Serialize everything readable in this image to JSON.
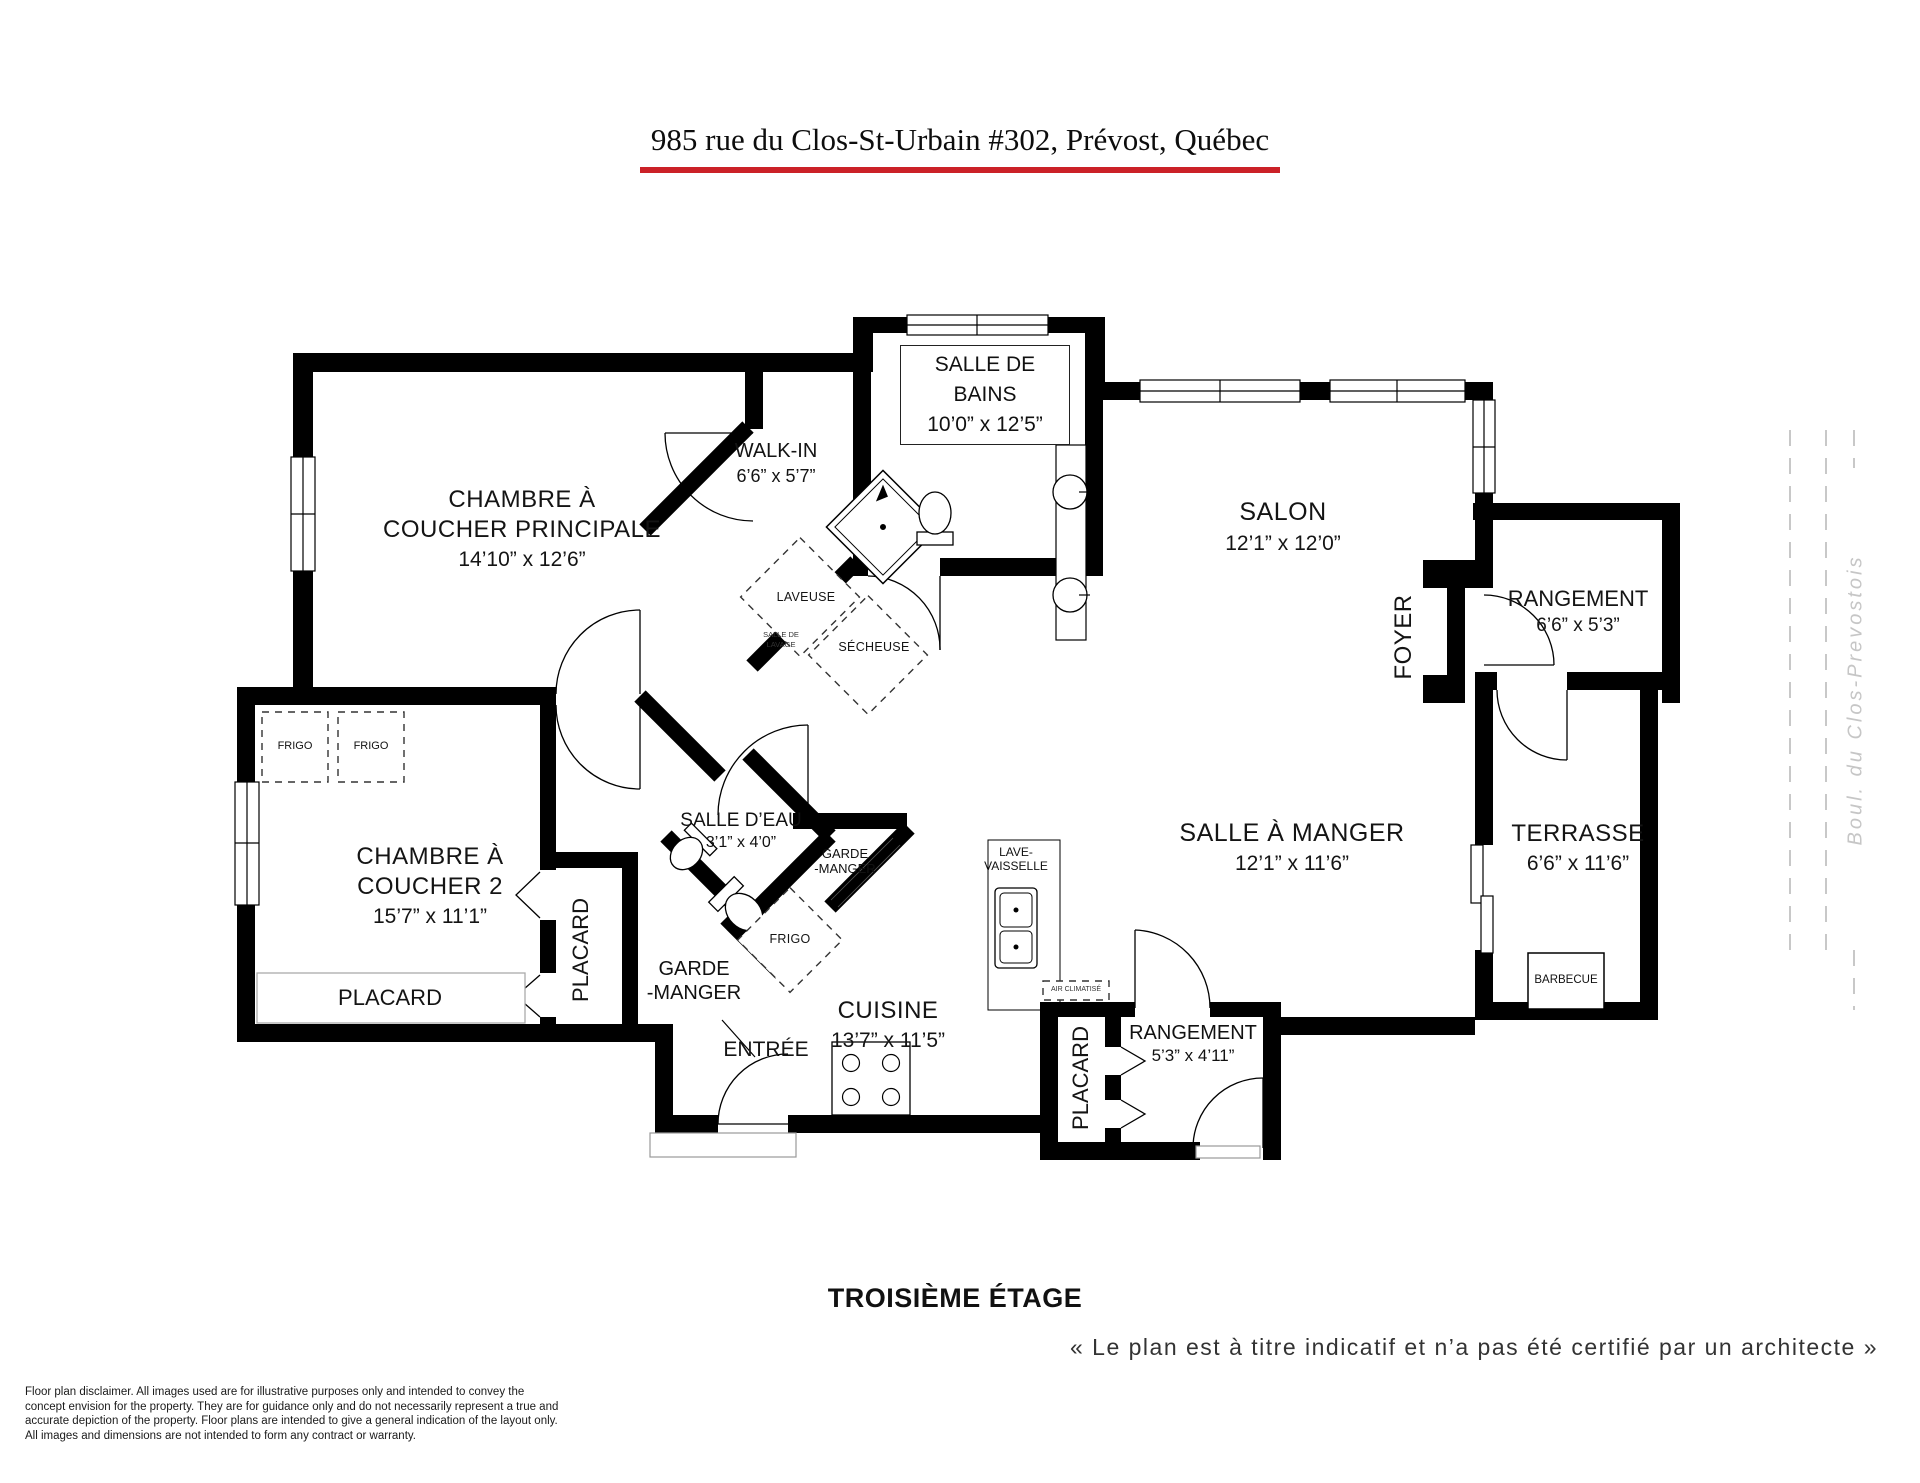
{
  "header": {
    "title": "985 rue du Clos-St-Urbain #302, Prévost, Québec",
    "underline_color": "#cb2127"
  },
  "rooms": {
    "master": {
      "name_line1": "CHAMBRE À",
      "name_line2": "COUCHER PRINCIPALE",
      "dims": "14’10” x 12’6”"
    },
    "walkin": {
      "name": "WALK-IN",
      "dims": "6’6” x 5’7”"
    },
    "bathroom": {
      "name_line1": "SALLE DE",
      "name_line2": "BAINS",
      "dims": "10’0” x 12’5”"
    },
    "salon": {
      "name": "SALON",
      "dims": "12’1” x 12’0”"
    },
    "foyer": {
      "name": "FOYER"
    },
    "storage_top": {
      "name": "RANGEMENT",
      "dims": "6’6” x 5’3”"
    },
    "bedroom2": {
      "name_line1": "CHAMBRE À",
      "name_line2": "COUCHER 2",
      "dims": "15’7” x 11’1”"
    },
    "powder": {
      "name": "SALLE D’EAU",
      "dims": "3’1” x 4’0”"
    },
    "dining": {
      "name": "SALLE À MANGER",
      "dims": "12’1” x 11’6”"
    },
    "kitchen": {
      "name": "CUISINE",
      "dims": "13’7” x 11’5”"
    },
    "entry": {
      "name": "ENTRÉE"
    },
    "terrace": {
      "name": "TERRASSE",
      "dims": "6’6” x 11’6”"
    },
    "storage_small": {
      "name": "RANGEMENT",
      "dims": "5’3” x 4’11”"
    },
    "closet_bedroom2_wall": {
      "name": "PLACARD"
    },
    "closet_bedroom2_vertical": {
      "name": "PLACARD"
    },
    "closet_kitchen": {
      "name": "PLACARD"
    },
    "laundry": {
      "washer": "LAVEUSE",
      "dryer": "SÉCHEUSE",
      "room_line1": "SALLE DE",
      "room_line2": "LAVAGE"
    },
    "pantry_small": {
      "line1": "GARDE",
      "line2": "-MANGER"
    },
    "pantry_large": {
      "line1": "GARDE",
      "line2": "-MANGER"
    }
  },
  "appliances": {
    "fridge1": "FRIGO",
    "fridge2": "FRIGO",
    "fridge_kitchen": "FRIGO",
    "dishwasher_line1": "LAVE-",
    "dishwasher_line2": "VAISSELLE",
    "ac": "AIR CLIMATISÉ",
    "bbq": "BARBECUE"
  },
  "road": {
    "label": "Boul. du Clos-Prevostois"
  },
  "footer": {
    "floor": "TROISIÈME ÉTAGE",
    "quote": "« Le plan est à titre indicatif et n’a pas été certifié par un architecte »",
    "disclaimer": [
      "Floor plan disclaimer. All images used are for illustrative purposes only and intended to convey the",
      "concept envision for the property. They are for guidance only and do not necessarily represent a true and",
      "accurate depiction of the property. Floor plans are intended to give a general indication of the layout only.",
      "All images and dimensions are not intended to form any contract or warranty."
    ]
  }
}
